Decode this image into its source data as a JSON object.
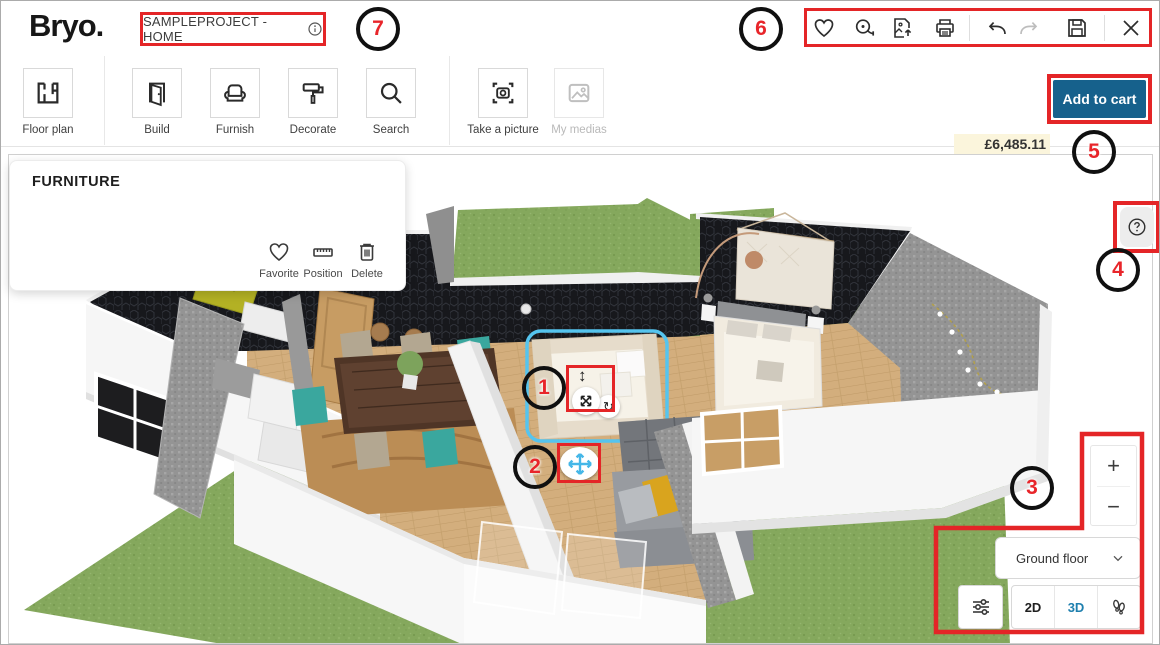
{
  "header": {
    "logo": "Bryo.",
    "project_name": "SAMPLEPROJECT - HOME"
  },
  "toolbar": {
    "items": [
      {
        "label": "Floor plan"
      },
      {
        "label": "Build"
      },
      {
        "label": "Furnish"
      },
      {
        "label": "Decorate"
      },
      {
        "label": "Search"
      },
      {
        "label": "Take a picture"
      },
      {
        "label": "My medias"
      }
    ]
  },
  "cart": {
    "price": "£6,485.11",
    "overview": "Project overview",
    "add_to_cart": "Add to cart"
  },
  "panel": {
    "title": "FURNITURE",
    "favorite": "Favorite",
    "position": "Position",
    "delete": "Delete"
  },
  "viewport": {
    "zoom_in": "+",
    "zoom_out": "−",
    "floor": "Ground floor",
    "view2d": "2D",
    "view3d": "3D"
  },
  "annotations": {
    "n1": "1",
    "n2": "2",
    "n3": "3",
    "n4": "4",
    "n5": "5",
    "n6": "6",
    "n7": "7"
  },
  "icons": [
    "favorite-icon",
    "tape-measure-icon",
    "add-media-icon",
    "print-icon",
    "undo-icon",
    "redo-icon",
    "save-icon",
    "close-icon",
    "info-icon",
    "floor-plan-icon",
    "door-icon",
    "armchair-icon",
    "paint-roller-icon",
    "search-icon",
    "camera-icon",
    "media-icon",
    "help-icon",
    "sliders-icon",
    "footsteps-icon",
    "chevron-down-icon",
    "heart-icon",
    "ruler-icon",
    "trash-icon",
    "move-icon",
    "rotate-icon",
    "resize-vertical-icon"
  ],
  "colors": {
    "annotation_red": "#e42527",
    "selection_cyan": "#55c4ee",
    "add_to_cart_bg": "#16618c",
    "link_blue": "#1b67b2",
    "active_3d": "#1e7fae",
    "price_highlight": "#fbf5dc"
  }
}
